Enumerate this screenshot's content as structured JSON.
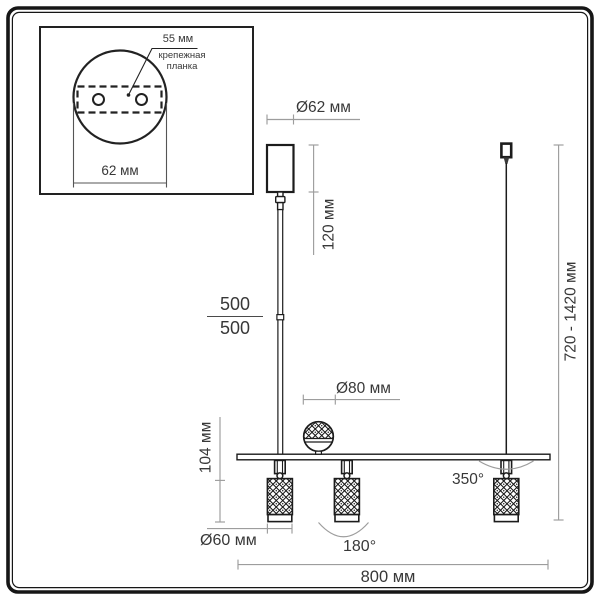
{
  "colors": {
    "outline": "#1c1c1c",
    "dimension_line": "#9d9d9d",
    "text": "#383838",
    "background": "#ffffff"
  },
  "inset": {
    "hole_pitch_label": "55 мм",
    "bracket_label_line1": "крепежная",
    "bracket_label_line2": "планка",
    "base_width_label": "62 мм"
  },
  "dims": {
    "canopy_diameter": "Ø62 мм",
    "canopy_height": "120 мм",
    "rod_section_top": "500",
    "rod_section_bottom": "500",
    "ball_diameter": "Ø80 мм",
    "head_drop": "104 мм",
    "shade_diameter": "Ø60 мм",
    "shade_tilt_angle": "180°",
    "head_rotation_angle": "350°",
    "bar_length": "800 мм",
    "suspension_height_range": "720 - 1420 мм"
  }
}
